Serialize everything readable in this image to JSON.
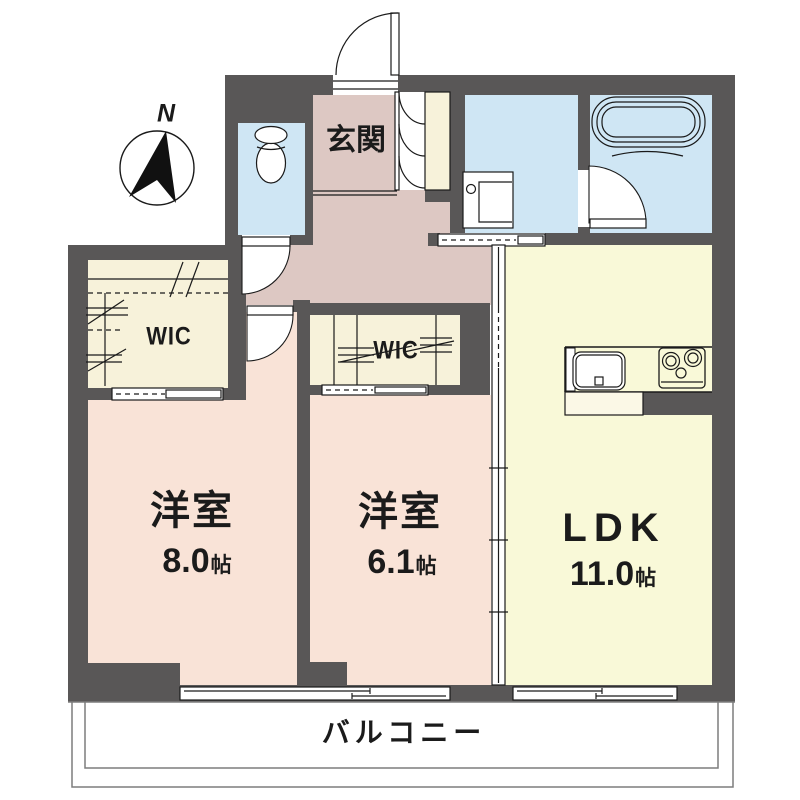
{
  "plan": {
    "title": "apartment-floor-plan",
    "compass": {
      "label": "N"
    },
    "rooms": {
      "genkan": {
        "label": "玄関"
      },
      "wic_left": {
        "label": "WIC"
      },
      "wic_center": {
        "label": "WIC"
      },
      "western1": {
        "label": "洋室",
        "size": "8.0",
        "unit": "帖"
      },
      "western2": {
        "label": "洋室",
        "size": "6.1",
        "unit": "帖"
      },
      "ldk": {
        "label": "LDK",
        "size": "11.0",
        "unit": "帖"
      },
      "balcony": {
        "label": "バルコニー"
      }
    },
    "icons": {
      "compass": "compass-north-icon",
      "toilet": "toilet-icon",
      "bathtub": "bathtub-icon",
      "vanity": "washbasin-icon",
      "sink": "kitchen-sink-icon",
      "stove": "stove-burners-icon"
    },
    "colors": {
      "wall": "#595757",
      "room_pink": "#f9e3d7",
      "hall_mauve": "#ddc8c3",
      "closet_cream": "#f7f2da",
      "ldk_yellow": "#f9f9d8",
      "wet_blue": "#cfe6f4"
    }
  }
}
